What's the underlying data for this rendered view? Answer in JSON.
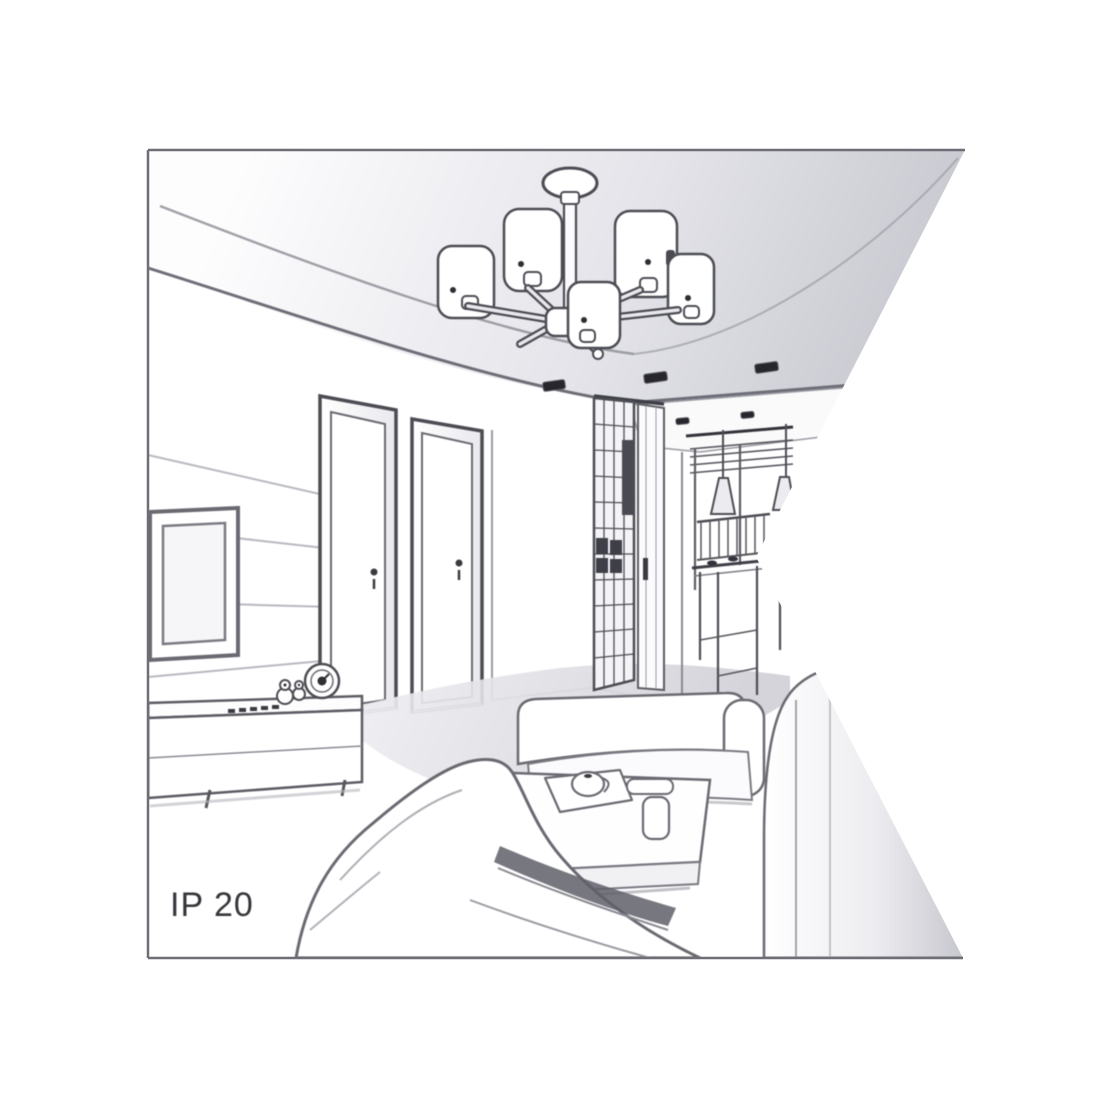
{
  "image": {
    "kind": "product illustration",
    "description": "Grayscale perspective sketch of a living room interior showing a multi-arm ceiling chandelier with cylindrical shades, tray ceiling with recessed spotlights, two interior doors, wardrobe, chest of drawers, dining corner with cone pendant lamps, TV wall with sideboard, sofas and a coffee table. A white wedge cuts into the picture from the right edge.",
    "ip_rating_label": "IP 20"
  },
  "labels": {
    "ip_rating": "IP 20"
  },
  "colors": {
    "background": "#ffffff",
    "frame_border": "#6e6e76",
    "line_dark": "#4c4c54",
    "line_mid": "#7a7a82",
    "line_light": "#b2b2ba",
    "ceiling_light": "#fbfbfc",
    "ceiling_dark": "#c7c7cf",
    "floor_shade": "#d6d6dc",
    "spotlight_dark": "#26262c",
    "shadow_wedge": "#5f5f68",
    "text": "#35353b"
  },
  "scene_parts": [
    "picture-frame-border",
    "ceiling-chandelier",
    "ceiling-spotlights",
    "tray-ceiling",
    "wall-panel-tv-frame",
    "interior-door-left",
    "interior-door-right",
    "wardrobe-lattice",
    "chest-of-drawers",
    "dining-pendant-lamps",
    "dining-table-and-chairs",
    "sideboard-with-clock-and-toys",
    "sofa-foreground",
    "sofa-middle",
    "sofa-right",
    "coffee-table-with-tea-set",
    "white-wedge-cutout",
    "ip-rating-text"
  ]
}
